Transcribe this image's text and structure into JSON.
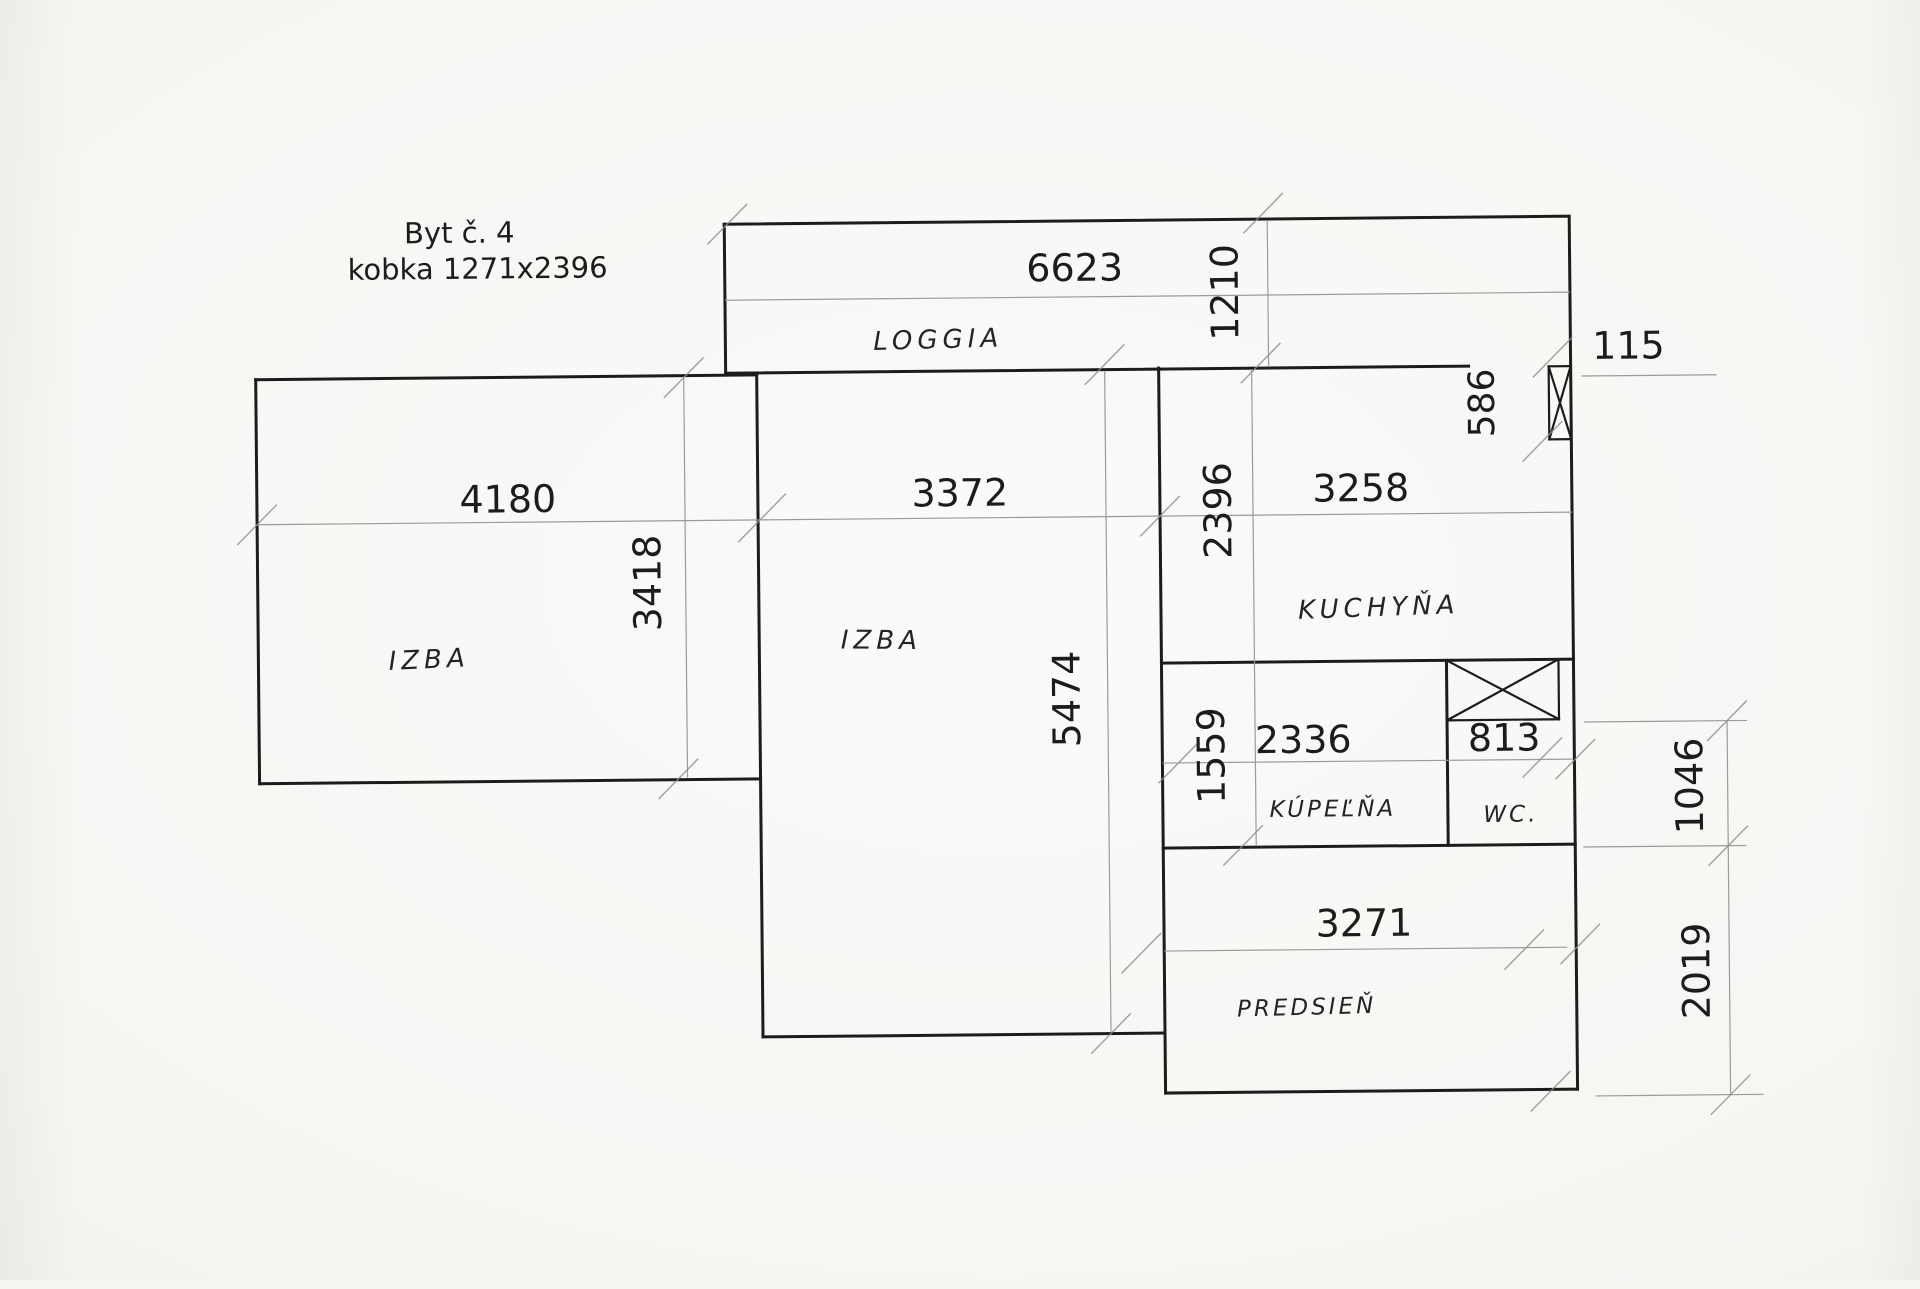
{
  "title": {
    "line1": "Byt č. 4",
    "line2": "kobka 1271x2396"
  },
  "rooms": {
    "loggia": "LOGGIA",
    "izba_left": "IZBA",
    "izba_middle": "IZBA",
    "kuchyna": "KUCHYŇA",
    "kupelna": "KÚPEĽŇA",
    "wc": "WC.",
    "predsien": "PREDSIEŇ"
  },
  "dimensions_mm": {
    "loggia_width": "6623",
    "loggia_depth": "1210",
    "pier_width": "115",
    "pier_height": "586",
    "izba_left_width": "4180",
    "izba_left_depth": "3418",
    "izba_middle_width": "3372",
    "izba_middle_depth": "5474",
    "kuchyna_width": "3258",
    "kuchyna_depth": "2396",
    "kupelna_width": "2336",
    "kupelna_depth": "1559",
    "wc_width": "813",
    "wc_shaft_to_wall": "1046",
    "predsien_width": "3271",
    "predsien_depth": "2019"
  },
  "colors": {
    "paper": "#f6f5f2",
    "ink": "#1c1c1c",
    "dim_line": "#9b9b9b",
    "handwriting": "#242424"
  }
}
